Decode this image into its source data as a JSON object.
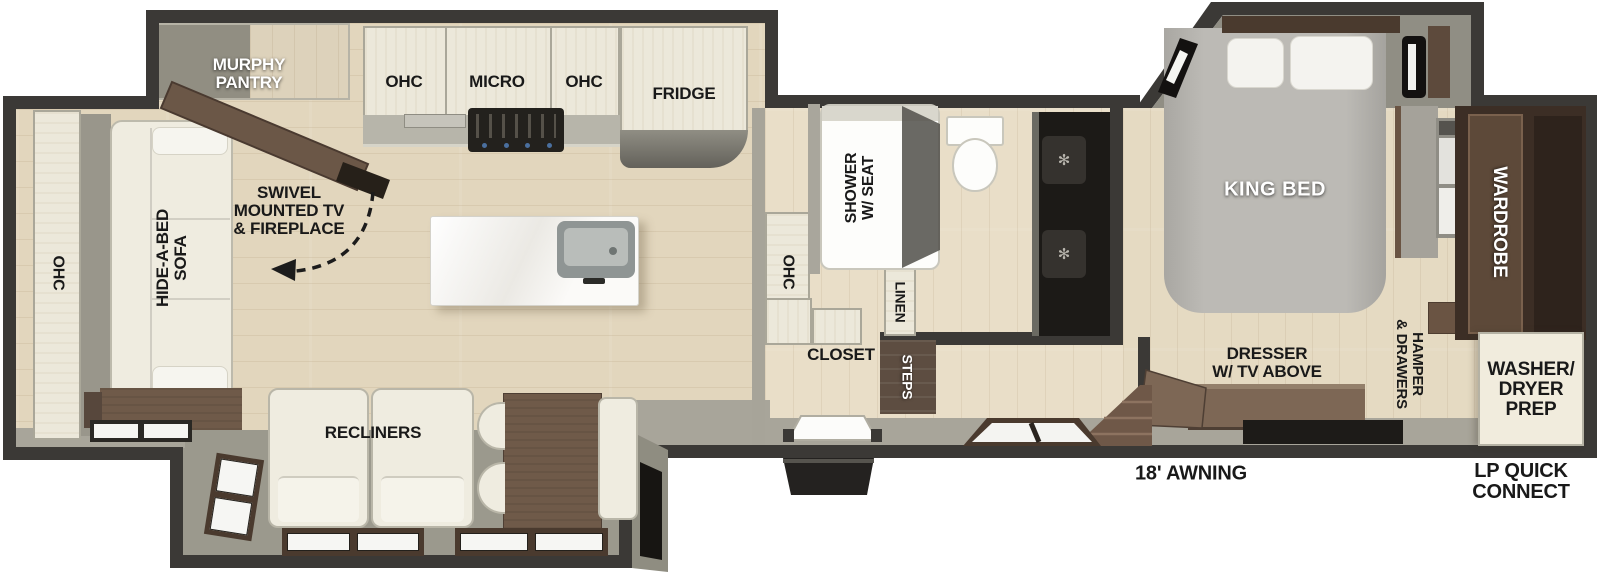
{
  "diagram_type": "rv-travel-trailer-floorplan",
  "labels": {
    "murphy_pantry": "MURPHY\nPANTRY",
    "swivel_tv": "SWIVEL\nMOUNTED TV\n& FIREPLACE",
    "ohc_rear": "OHC",
    "hide_a_bed_sofa": "HIDE-A-BED\nSOFA",
    "recliners": "RECLINERS",
    "ohc_kitchen_left": "OHC",
    "micro": "MICRO",
    "ohc_kitchen_right": "OHC",
    "fridge": "FRIDGE",
    "ohc_mid": "OHC",
    "shower": "SHOWER\nW/ SEAT",
    "linen": "LINEN",
    "closet": "CLOSET",
    "steps": "STEPS",
    "king_bed": "KING BED",
    "dresser_tv": "DRESSER\nW/ TV ABOVE",
    "hamper_drawers": "HAMPER\n& DRAWERS",
    "wardrobe": "WARDROBE",
    "washer_dryer_prep": "WASHER/\nDRYER\nPREP",
    "awning": "18' AWNING",
    "lp_quick_connect": "LP QUICK\nCONNECT"
  },
  "colors": {
    "wall": "#3b3936",
    "wood_floor": "#e2d6bd",
    "slide_gray": "#9b998d",
    "cabinet_cream": "#ece8da",
    "furniture_brown": "#6f5a49",
    "accent_black": "#1d1b18",
    "label_dark": "#191919",
    "label_light": "#ffffff"
  }
}
